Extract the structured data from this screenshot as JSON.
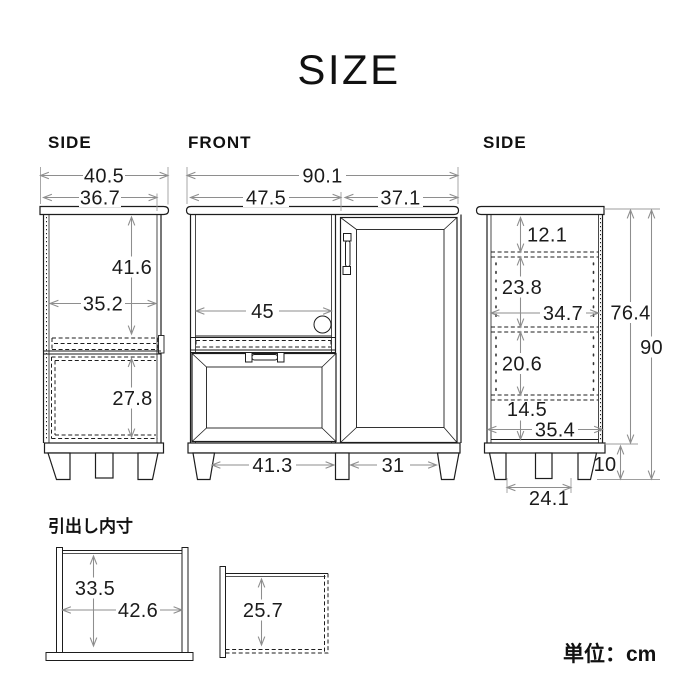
{
  "title": "SIZE",
  "unit_note": "単位：cm",
  "colors": {
    "ink": "#1d1d1d",
    "dimension_line": "#8e8e8e"
  },
  "views": {
    "side_left": {
      "label": "SIDE",
      "d_total_depth": "40.5",
      "d_body_depth": "36.7",
      "d_upper_height": "41.6",
      "d_inner_depth": "35.2",
      "d_lower_height": "27.8"
    },
    "front": {
      "label": "FRONT",
      "d_total_width": "90.1",
      "d_left_width": "47.5",
      "d_right_width": "37.1",
      "d_opening_width": "45",
      "d_leg_gap_left": "41.3",
      "d_leg_gap_right": "31"
    },
    "side_right": {
      "label": "SIDE",
      "d_top_section": "12.1",
      "d_upper_section": "23.8",
      "d_mid_depth": "34.7",
      "d_lower_section": "20.6",
      "d_bottom_section": "14.5",
      "d_bottom_depth": "35.4",
      "d_body_height": "76.4",
      "d_total_height": "90",
      "d_leg_height": "10",
      "d_leg_gap": "24.1"
    },
    "drawer_inner": {
      "label": "引出し内寸",
      "d_height": "33.5",
      "d_width": "42.6",
      "d_depth_height": "25.7"
    }
  }
}
